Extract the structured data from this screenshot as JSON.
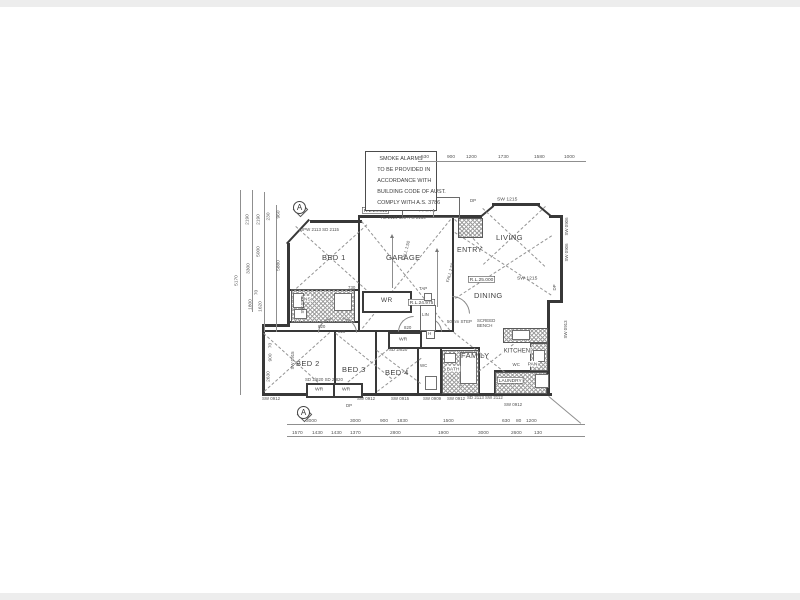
{
  "colors": {
    "ink": "#3b3b3b",
    "paper": "#ffffff"
  },
  "drawing": {
    "note_lines": [
      "SMOKE ALARMS",
      "TO BE PROVIDED IN",
      "ACCORDANCE WITH",
      "BUILDING CODE OF AUST.",
      "COMPLY WITH A.S. 3786"
    ],
    "rooms": {
      "bed1": "BED 1",
      "bed2": "BED 2",
      "bed3": "BED 3",
      "bed4": "BED 4",
      "garage": "GARAGE",
      "entry": "ENTRY",
      "living": "LIVING",
      "dining": "DINING",
      "family": "FAMILY",
      "kitchen": "KITCHEN",
      "patio": "PATIO",
      "ens": "ENS",
      "bath": "BATH",
      "wc_bath": "WC",
      "wc_kitchen": "WC",
      "pan": "PAN",
      "lin": "LIN",
      "laundry": "LAUNDRY",
      "wr_bed1": "WR",
      "wr_hall": "WR",
      "wr_bed2": "WR",
      "wr_bed3": "WR"
    },
    "levels": {
      "patio": "R.L.24.515",
      "garage": "R.L.24.975",
      "floor": "R.L.25.000"
    },
    "ann": {
      "fall1": "FALL 1:50",
      "fall2": "FALL 1:50",
      "tap": "TAP",
      "step": "50mm STEP",
      "bench1": "SCREED",
      "bench2": "BENCH",
      "dp1": "DP",
      "dp2": "DP",
      "dp3": "DP",
      "patio_spec": "RL 2124 600+FG 2154",
      "d820a": "820",
      "d820b": "820",
      "d820c": "820",
      "d730": "730",
      "sd_hall": "SD 2/820",
      "sd_wr2": "SD 2/820  SD 2/820",
      "hinge": "H",
      "section": "A"
    },
    "open": {
      "top_dpw": "DPW 2113 SD 2115",
      "top_sw1215": "SW 1215",
      "right_sw0906a": "SW 0906",
      "right_sw0906b": "SW 0906",
      "right_sw1215": "SW 1215",
      "right_sw0913": "SW 0913",
      "left_sw0909": "SW 0909",
      "left_sw0915": "SW 0915",
      "b_sw0912a": "SW 0912",
      "b_sw0912b": "SW 0912",
      "b_sw0915": "SW 0915",
      "b_sw0909": "SW 0909",
      "b_sw0912c": "SW 0912",
      "b_sd2113": "SD 2113 SW 2112",
      "b_sw0912d": "SW 0912"
    },
    "dims": {
      "top": [
        "530",
        "900",
        "1200",
        "1730",
        "1580",
        "1000"
      ],
      "left": [
        "2190",
        "2190",
        "230",
        "960",
        "5000",
        "3300",
        "5880",
        "5170",
        "70",
        "1800",
        "1620",
        "70",
        "900",
        "2630"
      ],
      "bot1": [
        "3000",
        "3000",
        "900",
        "1830",
        "1500",
        "630",
        "80",
        "1200"
      ],
      "bot2": [
        "1570",
        "1430",
        "1430",
        "1370",
        "2800",
        "1900",
        "3000",
        "2600",
        "130"
      ]
    }
  }
}
